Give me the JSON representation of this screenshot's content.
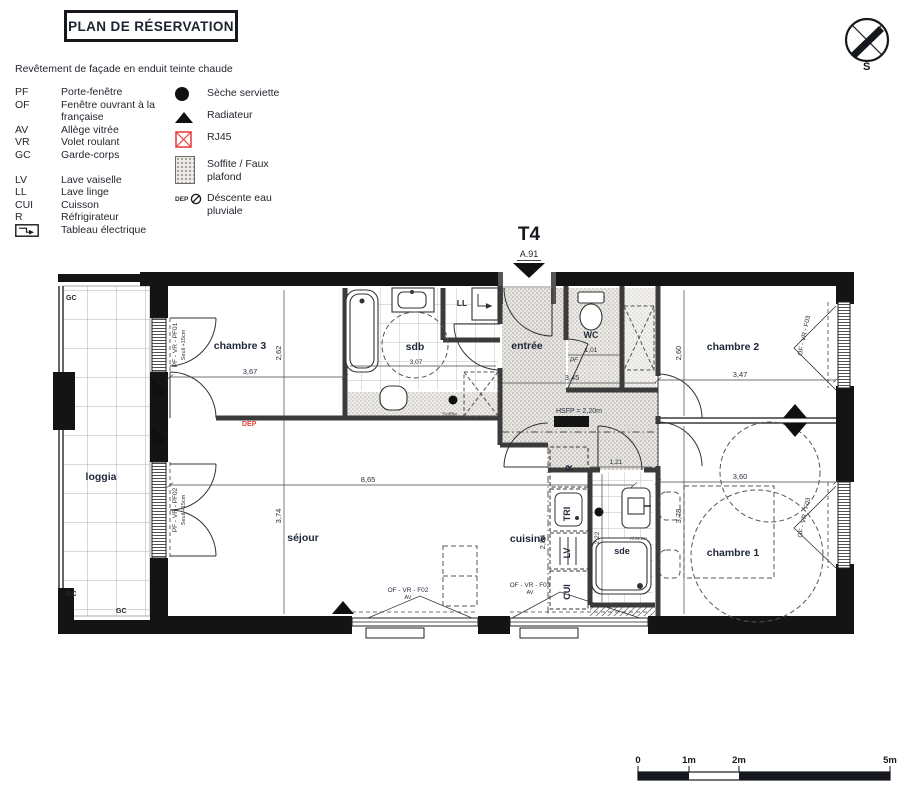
{
  "header": {
    "title": "PLAN DE RÉSERVATION",
    "facade_note": "Revêtement de façade en enduit teinte chaude",
    "compass_label": "S"
  },
  "legend": {
    "abbreviations": [
      {
        "abbr": "PF",
        "label": "Porte-fenêtre"
      },
      {
        "abbr": "OF",
        "label": "Fenêtre ouvrant à la française"
      },
      {
        "abbr": "AV",
        "label": "Allège vitrée"
      },
      {
        "abbr": "VR",
        "label": "Volet roulant"
      },
      {
        "abbr": "GC",
        "label": "Garde-corps"
      },
      {
        "abbr": "LV",
        "label": "Lave vaiselle"
      },
      {
        "abbr": "LL",
        "label": "Lave linge"
      },
      {
        "abbr": "CUI",
        "label": "Cuisson"
      },
      {
        "abbr": "R",
        "label": "Réfrigirateur"
      },
      {
        "abbr": "",
        "label": "Tableau électrique",
        "icon": "electrical-panel-icon"
      }
    ],
    "symbols": [
      {
        "icon": "towel-dryer-icon",
        "label": "Sèche serviette"
      },
      {
        "icon": "radiator-icon",
        "label": "Radiateur"
      },
      {
        "icon": "rj45-icon",
        "label": "RJ45"
      },
      {
        "icon": "soffit-icon",
        "label": "Soffite / Faux plafond"
      },
      {
        "icon": "rainwater-icon",
        "label": "Déscente eau pluviale",
        "prefix": "DEP"
      }
    ]
  },
  "plan": {
    "unit_type": "T4",
    "unit_ref": "A.91",
    "rooms": {
      "loggia": "loggia",
      "chambre3": "chambre 3",
      "sdb": "sdb",
      "entree": "entrée",
      "wc": "WC",
      "chambre2": "chambre 2",
      "sejour": "séjour",
      "cuisine": "cuisine",
      "sde": "sde",
      "chambre1": "chambre 1"
    },
    "appliances": {
      "fridge": "R",
      "sorting": "TRI",
      "dishwasher": "LV",
      "cooking": "CUI",
      "washer": "LL"
    },
    "dims": {
      "ch3_w": "3,67",
      "ch3_h": "2,62",
      "sdb_w": "3,07",
      "entree_w": "3,45",
      "wc_w": "1,01",
      "ch2_w": "3,47",
      "ch2_h": "2,60",
      "sejour_w": "8,65",
      "sejour_h": "3,74",
      "kitchen_h": "2,84",
      "sde_w": "1,21",
      "sde_h": "2,22",
      "ch1_w": "3,60",
      "ch1_h": "3,78"
    },
    "notes": {
      "hsfp": "HSFP = 2,20m",
      "pf": "PF",
      "dep": "DEP",
      "soffite": "Soffite",
      "reseau": "réseau",
      "gc": "GC"
    },
    "windows": {
      "pf01": "PF - VR - PF01",
      "pf01_sill": "Seuil +15cm",
      "pf02": "PF - VR - PF02",
      "pf02_sill": "Seuil +15cm",
      "f02": "OF - VR - F02",
      "f02_av": "AV",
      "f03": "OF - VR - F03"
    }
  },
  "scalebar": {
    "t0": "0",
    "t1": "1m",
    "t2": "2m",
    "t5": "5m"
  }
}
